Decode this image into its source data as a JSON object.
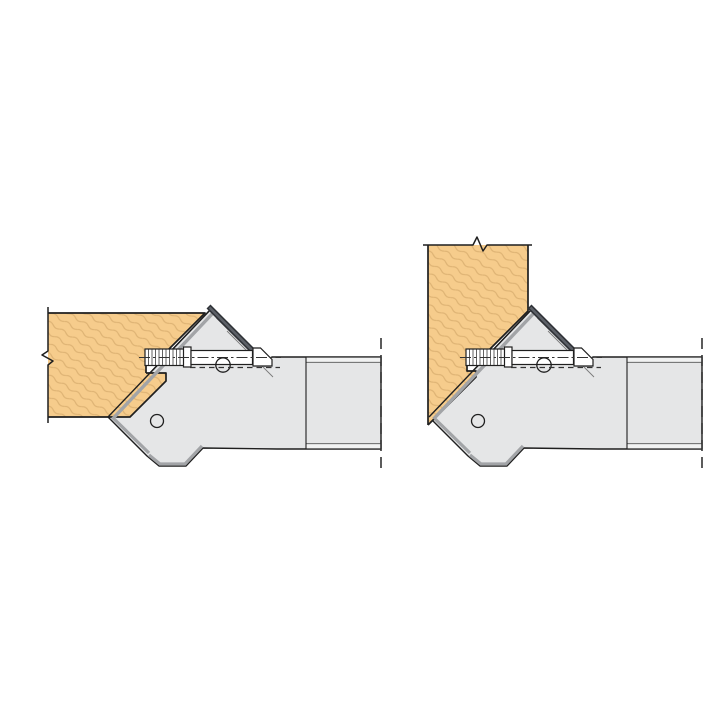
{
  "title": "45-degree chamfer cutter head diagrams",
  "canvas": {
    "width": 720,
    "height": 720
  },
  "colors": {
    "bg": "#ffffff",
    "wood-fill": "#f6cc8c",
    "wood-grain": "#ddb273",
    "steel-fill": "#e5e6e7",
    "steel-strip": "#f1f2f2",
    "steel-shade": "#a2a4a7",
    "outline": "#1f1f1f",
    "knife-dark": "#2e3136",
    "knife-mid": "#5c6067",
    "line-gray": "#555555",
    "dash-gray": "#333333"
  },
  "diagrams": [
    {
      "id": "left",
      "workpiece_orientation": "horizontal-board",
      "cut_type": "45-degree-chamfer-on-board-end",
      "parts": [
        "workpiece",
        "cutter-body",
        "insert-knife",
        "clamping-screw",
        "pivot-hole",
        "body-hole",
        "spindle-hub",
        "spindle-axis-centerline",
        "break-symbol"
      ]
    },
    {
      "id": "right",
      "workpiece_orientation": "vertical-board",
      "cut_type": "45-degree-chamfer-on-board-bottom-corner",
      "parts": [
        "workpiece",
        "cutter-body",
        "insert-knife",
        "clamping-screw",
        "pivot-hole",
        "body-hole",
        "spindle-hub",
        "spindle-axis-centerline",
        "break-symbol"
      ]
    }
  ]
}
